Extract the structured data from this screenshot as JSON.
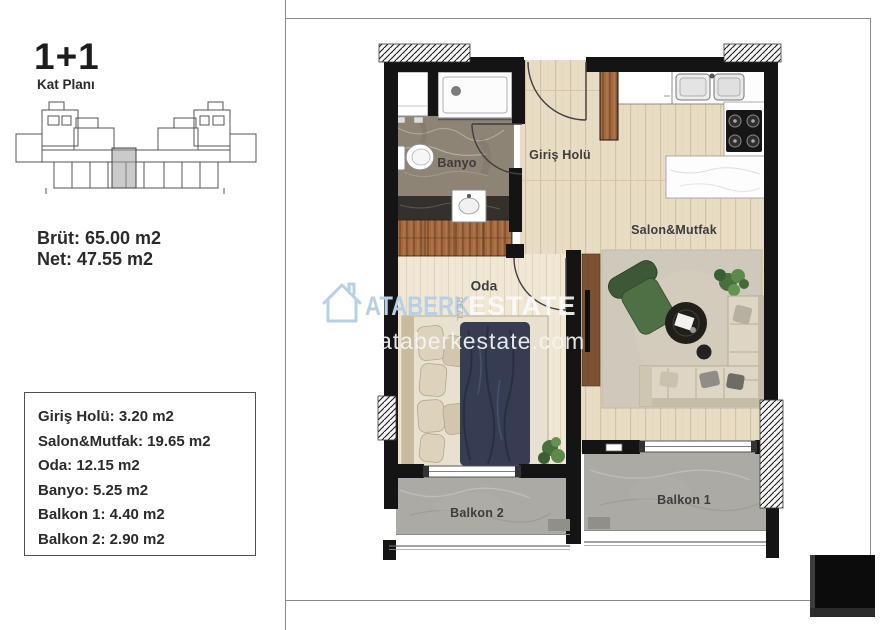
{
  "header": {
    "unit_type": "1+1",
    "plan_label": "Kat Planı"
  },
  "metrics": {
    "gross": "Brüt: 65.00 m2",
    "net": "Net: 47.55 m2"
  },
  "area_table": {
    "items": [
      "Giriş Holü: 3.20 m2",
      "Salon&Mutfak: 19.65 m2",
      "Oda: 12.15 m2",
      "Banyo: 5.25 m2",
      "Balkon 1: 4.40 m2",
      "Balkon 2: 2.90 m2"
    ]
  },
  "plan": {
    "rooms": {
      "banyo": "Banyo",
      "giris_holu": "Giriş Holü",
      "salon_mutfak": "Salon&Mutfak",
      "oda": "Oda",
      "balkon_1": "Balkon 1",
      "balkon_2": "Balkon 2"
    }
  },
  "watermark": {
    "brand_first": "ATABERK",
    "brand_middle": "REAL",
    "brand_last": "ESTATE",
    "website": "ataberkestate.com"
  },
  "colors": {
    "watermark_blue": "#b7d0e6",
    "wall_black": "#141414",
    "wood_floor": "#e8dcc4",
    "bedroom_floor": "#f0e7d4",
    "stone_floor": "#abaaa5",
    "bath_marble": "#8e8476",
    "duvet_navy": "#363d52",
    "armchair_green": "#3c5836",
    "sofa_beige": "#ded6c4",
    "key_plan_highlight": "#9e9e9e"
  }
}
